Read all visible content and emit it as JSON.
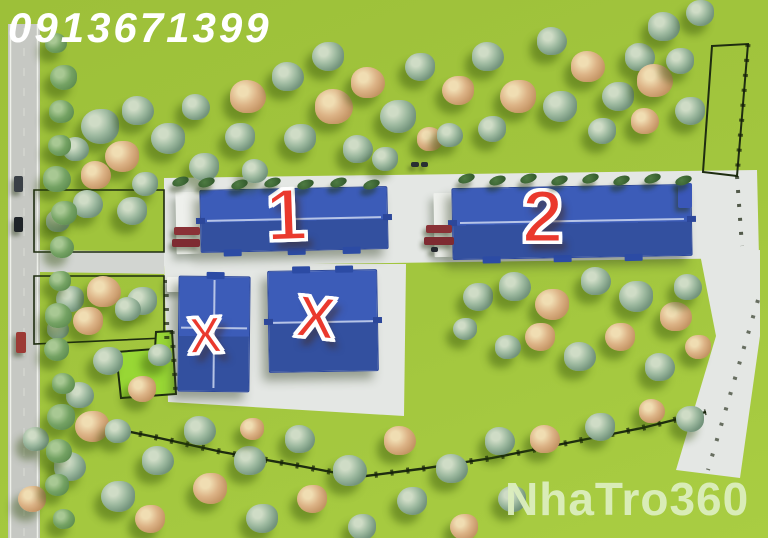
{
  "overlay": {
    "phone_number": "0913671399",
    "watermark": "NhaTro360"
  },
  "labels": {
    "building_1": "1",
    "building_2": "2",
    "building_x_left": "X",
    "building_x_right": "X"
  },
  "colors": {
    "grass_green": "#a2c63e",
    "grass_green_dark": "#9dc039",
    "highlight_plot_green": "#98d735",
    "roof_blue": "#3c5cb8",
    "roof_blue_dark": "#33509f",
    "label_red": "#ea392d",
    "label_outline": "#ffffff",
    "concrete_pad": "#e4e7e4",
    "access_road": "#d2d5d1",
    "road_gray": "#c6c8c3",
    "fence_dark": "#1e2c10",
    "truck_red": "#8a3136",
    "watermark_text": "#dceebe",
    "phone_text": "#ffffff"
  }
}
